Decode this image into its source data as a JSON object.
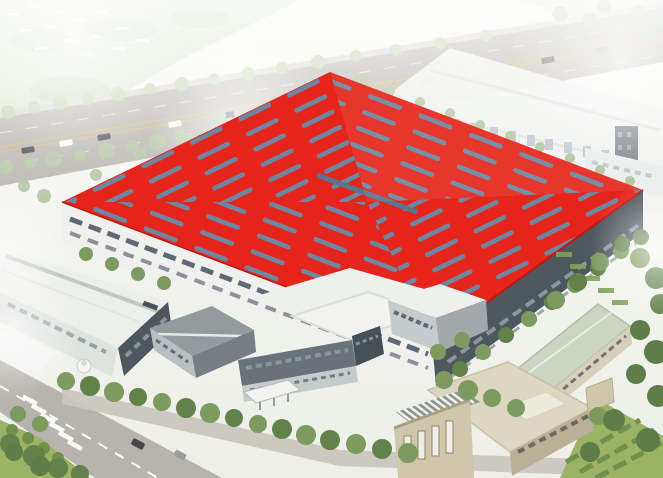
{
  "scene": {
    "type": "aerial architectural rendering",
    "subject": "industrial factory campus dominated by a large red-roof production hall with slate skylight strips",
    "landmarks": {
      "red_roof_hall": "main production hall, bright red roof with herringbone skylight dashes and central ridge light",
      "background_factory": "large hazy white factory building across the rear boulevard",
      "left_warehouse": "long warehouse with white roof, ridge skylight and dark end walls",
      "office_building": "front office complex with gray wing and entrance canopy",
      "beige_building": "auxiliary beige building with rooftop louver pergola",
      "green_roof_building": "long narrow utility building with pale green roof",
      "highway": "boulevard with traffic running diagonally across the top",
      "campus_road": "tree-lined street with zebra crosswalk at bottom left",
      "guard_booth": "small round white gatehouse",
      "birds": "flock of white birds over the hazy green field, top left"
    },
    "counts": {
      "highway_cars": 12,
      "street_cars": 2,
      "birds": 14
    }
  },
  "colors": {
    "roof_red": "#e5251b",
    "roof_red_shadow": "#bd1911",
    "skylight_slate": "#6e86a0",
    "ridge_slate": "#5a7390",
    "wall_white": "#f0f1ee",
    "wall_dark": "#4e565e",
    "window_slate": "#5f6a74",
    "wall_dark_window": "#8b959e",
    "roof_white": "#edefec",
    "warehouse_ridge": "#c3c8c3",
    "warehouse_end": "#dfe2df",
    "road_gray": "#b7b4ae",
    "road_edge_light": "#d9d7d2",
    "road_line_yellow": "#d9c06a",
    "road_inner": "#c9c6bf",
    "field_green": "#dce5cf",
    "field_mottle": "#ccd8bb",
    "tree_pale": "#c3d2b0",
    "tree_palemid": "#b3c4a0",
    "tree_mid": "#7d9a60",
    "tree_dark": "#62824c",
    "tree_deep": "#5e7d49",
    "eave_tree": "#a9bd93",
    "lawn_green": "#9cb264",
    "hedge_green": "#71904c",
    "bg_factory_white": "#eef0ed",
    "bg_roofline": "#dde1dc",
    "bg_window": "#b9c1c8",
    "bg_slab": "#6d737a",
    "bg_block_white": "#e9ebea",
    "beige_wall": "#cfc7ab",
    "beige_wall_dark": "#b9b098",
    "beige_roof": "#ddd7c1",
    "beige_trim": "#c8c1a6",
    "sage_roof": "#cbd5c2",
    "sage_ridge": "#e6ebe2",
    "sage_wall": "#d6d0bb",
    "sage_window": "#6f7568",
    "louver_base": "#8e958f",
    "louver_slat": "#f2f3ee",
    "parapet_white": "#eceada",
    "office_roof_white": "#eef0ed",
    "office_gray_roof": "#949b9e",
    "office_gray_wall": "#787f84",
    "office_gray_face": "#b9bec0",
    "office_band_dark": "#6a7178",
    "office_band_light": "#c6cbcb",
    "office_right_wall": "#a2a8ac",
    "office_tower_dark": "#474f57",
    "canopy_white": "#f2f3f1",
    "booth_white": "#f4f5f3",
    "car_dark": "#45474a",
    "car_white": "#fbfbf9",
    "car_silver": "#9a9da0",
    "haze_white": "#ffffff",
    "bird_white": "#ffffff"
  }
}
